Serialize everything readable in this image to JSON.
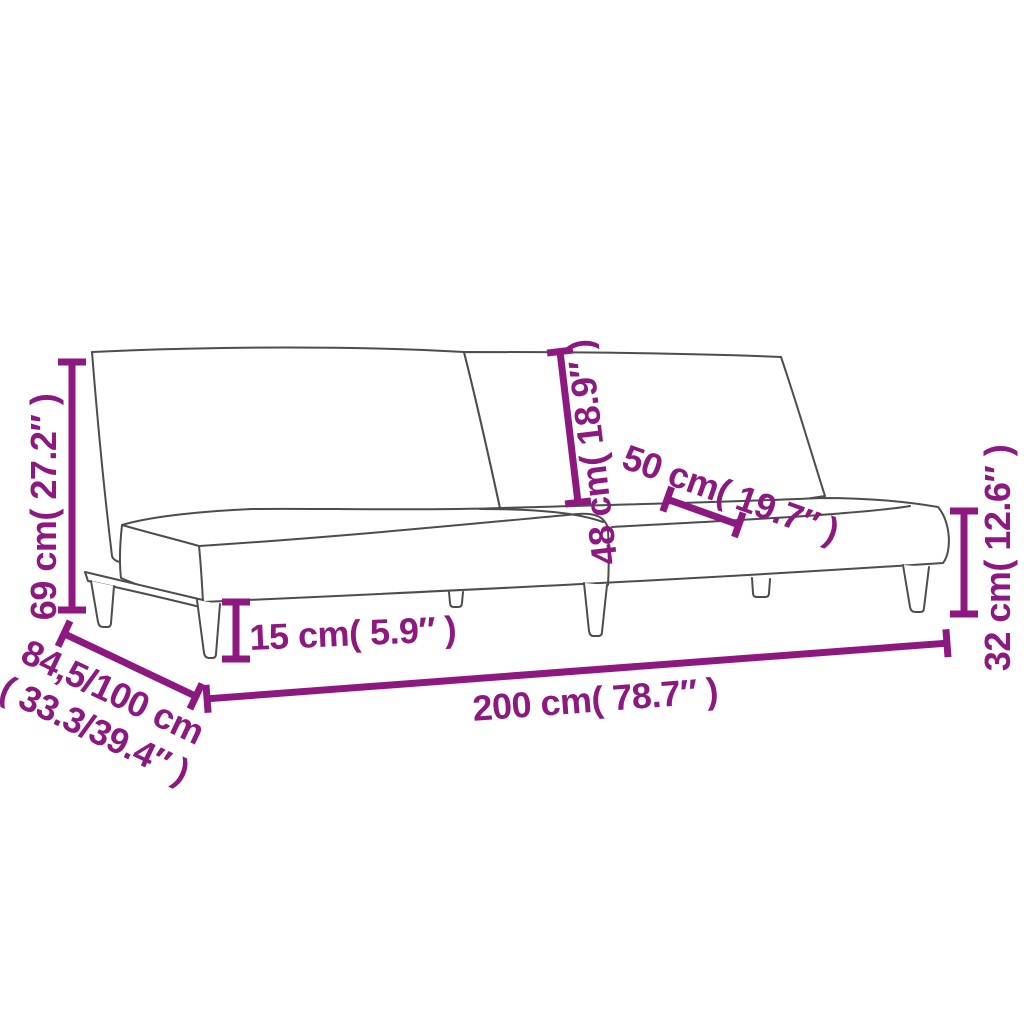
{
  "figure": {
    "title": "sofa-bed-dimension-diagram",
    "background": "#FFFFFF",
    "accent_color": "#8D1980",
    "outline_color": "#4D4D4D"
  },
  "dims": [
    {
      "id": "overall-height",
      "text": "69 cm( 27.2″ )"
    },
    {
      "id": "backrest-height",
      "text": "48 cm( 18.9″ )"
    },
    {
      "id": "backrest-width",
      "text": "50 cm( 19.7″ )"
    },
    {
      "id": "platform-height",
      "text": "32 cm( 12.6″ )"
    },
    {
      "id": "leg-height",
      "text": "15 cm( 5.9″ )"
    },
    {
      "id": "overall-length",
      "text": "200 cm( 78.7″ )"
    },
    {
      "id": "depth-range",
      "text": "84,5/100 cm",
      "text2": "( 33.3/39.4″ )"
    }
  ]
}
